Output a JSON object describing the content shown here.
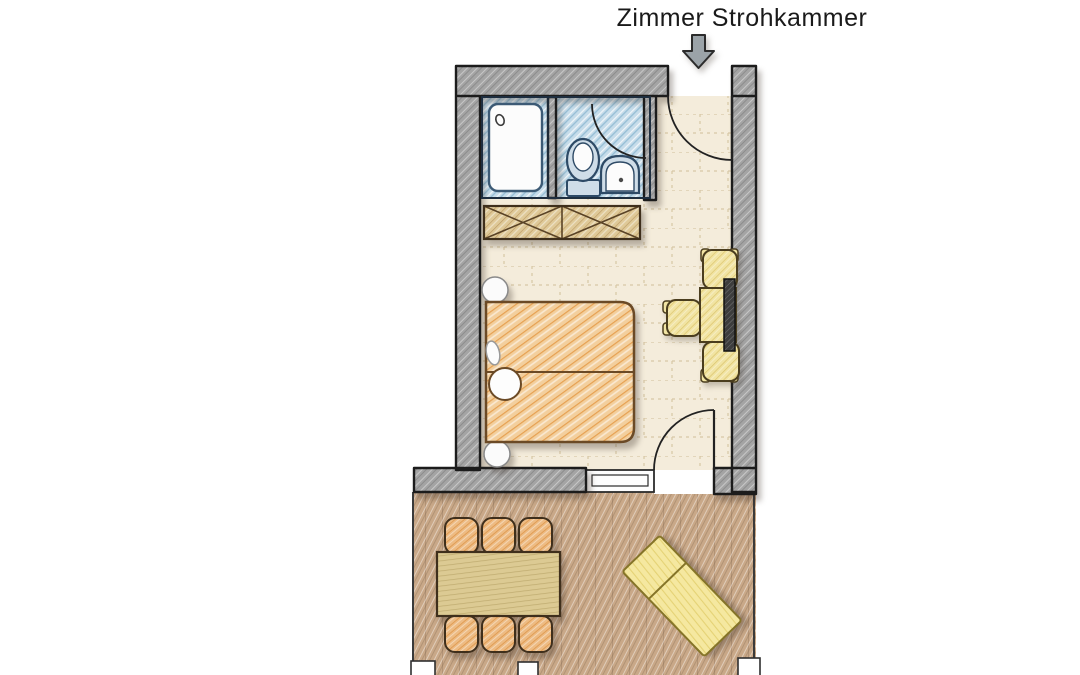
{
  "title": "Zimmer Strohkammer",
  "rooms": {
    "bedroom": "Zimmer",
    "bathroom": "Bad",
    "terrace": "Terrasse"
  },
  "colors": {
    "background": "#ffffff",
    "title_text": "#1a1a1a",
    "arrow": "#9ba3a8",
    "wall": "#a4a4a4",
    "wall_outline": "#1c1c1c",
    "room_floor": "#f4ecdb",
    "bathroom_floor": "#c6dcea",
    "fixture_fill": "#cfdde8",
    "fixture_white": "#fcfcfc",
    "fixture_outline": "#2e4a66",
    "furniture_outline": "#4a3a20",
    "wardrobe": "#dfc998",
    "bed": "#f3cf9d",
    "desk_set": "#f1e4a3",
    "radiator": "#3d3d3d",
    "deck": "#c9a888",
    "dining_chair": "#edbb83",
    "dining_table": "#dcca93",
    "lounger": "#f5e8a0"
  }
}
